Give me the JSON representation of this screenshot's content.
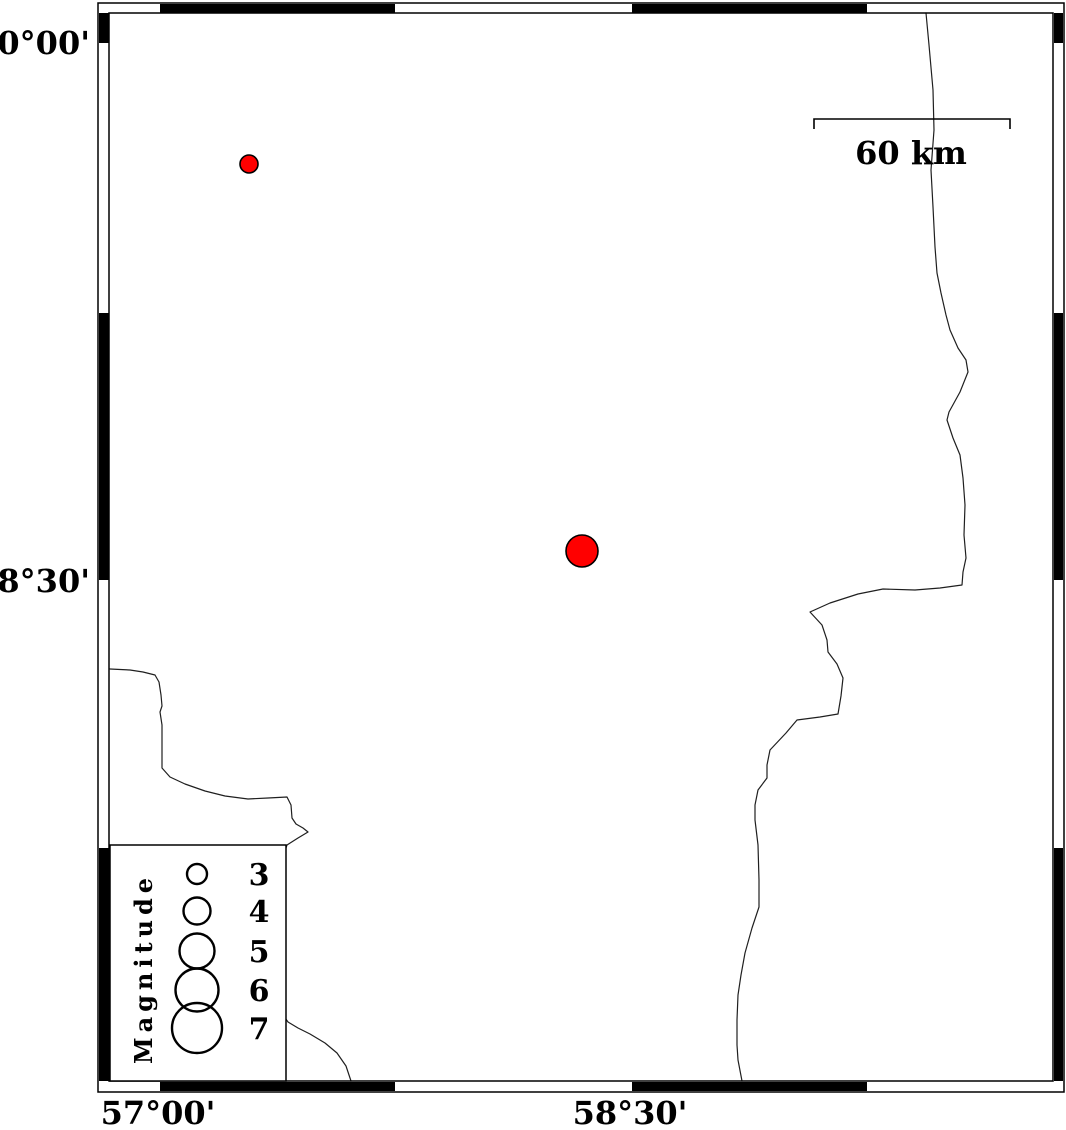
{
  "figure": {
    "kind": "earthquake-epicenter-map",
    "width": 1066,
    "height": 1130,
    "background": "#ffffff"
  },
  "colors": {
    "frame": "#000000",
    "coastline": "#1f1f1f",
    "epicenter_fill": "#ff0000",
    "epicenter_stroke": "#000000",
    "legend_box_fill": "#ffffff"
  },
  "frame": {
    "outer": {
      "x": 98,
      "y": 3,
      "w": 966,
      "h": 1089
    },
    "inner": {
      "x": 109,
      "y": 13,
      "w": 944,
      "h": 1068
    },
    "black_x_segments": [
      [
        160,
        395
      ],
      [
        632,
        867
      ]
    ],
    "black_y_segments": [
      [
        13,
        43
      ],
      [
        313,
        580
      ],
      [
        848,
        1081
      ]
    ]
  },
  "axis_labels": {
    "lat": [
      {
        "text": "30°00'",
        "x": 90,
        "y": 54
      },
      {
        "text": "28°30'",
        "x": 90,
        "y": 592
      }
    ],
    "lon": [
      {
        "text": "57°00'",
        "x": 158,
        "y": 1124
      },
      {
        "text": "58°30'",
        "x": 630,
        "y": 1124
      }
    ]
  },
  "scale_bar": {
    "label": "60 km",
    "x1": 814,
    "x2": 1010,
    "y": 119,
    "tick_drop": 10,
    "label_x": 911,
    "label_y": 164
  },
  "earthquakes": [
    {
      "cx": 249,
      "cy": 164,
      "r": 9,
      "magnitude_approx": 3
    },
    {
      "cx": 582,
      "cy": 551,
      "r": 16,
      "magnitude_approx": 5
    }
  ],
  "legend": {
    "title": "Magnitude",
    "box": {
      "x": 110,
      "y": 845,
      "w": 176,
      "h": 236
    },
    "title_translate_x": 152,
    "title_translate_y": 1064,
    "circle_cx": 197,
    "label_x": 259,
    "entries": [
      {
        "label": "3",
        "cy": 874,
        "r": 10,
        "label_y": 885
      },
      {
        "label": "4",
        "cy": 911,
        "r": 13.5,
        "label_y": 922
      },
      {
        "label": "5",
        "cy": 951,
        "r": 17.5,
        "label_y": 962
      },
      {
        "label": "6",
        "cy": 990,
        "r": 21.5,
        "label_y": 1001
      },
      {
        "label": "7",
        "cy": 1028,
        "r": 25,
        "label_y": 1039
      }
    ]
  },
  "coastlines": [
    {
      "name": "coastline-east",
      "points": [
        [
          926,
          13
        ],
        [
          929,
          45
        ],
        [
          933,
          90
        ],
        [
          934,
          130
        ],
        [
          931,
          170
        ],
        [
          933,
          207
        ],
        [
          935,
          247
        ],
        [
          937,
          273
        ],
        [
          941,
          293
        ],
        [
          946,
          315
        ],
        [
          950,
          330
        ],
        [
          958,
          348
        ],
        [
          966,
          360
        ],
        [
          968,
          372
        ],
        [
          960,
          392
        ],
        [
          949,
          412
        ],
        [
          947,
          420
        ],
        [
          953,
          438
        ],
        [
          960,
          455
        ],
        [
          963,
          478
        ],
        [
          965,
          505
        ],
        [
          964,
          535
        ],
        [
          966,
          558
        ],
        [
          963,
          572
        ],
        [
          962,
          585
        ],
        [
          940,
          588
        ],
        [
          915,
          590
        ],
        [
          883,
          589
        ],
        [
          858,
          594
        ],
        [
          830,
          603
        ],
        [
          810,
          612
        ],
        [
          822,
          625
        ],
        [
          827,
          640
        ],
        [
          828,
          652
        ],
        [
          837,
          664
        ],
        [
          843,
          678
        ],
        [
          841,
          696
        ],
        [
          838,
          714
        ],
        [
          820,
          717
        ],
        [
          797,
          720
        ],
        [
          786,
          733
        ],
        [
          770,
          750
        ],
        [
          767,
          765
        ],
        [
          767,
          778
        ],
        [
          758,
          790
        ],
        [
          755,
          805
        ],
        [
          755,
          820
        ],
        [
          758,
          845
        ],
        [
          759,
          880
        ],
        [
          759,
          907
        ],
        [
          752,
          928
        ],
        [
          745,
          953
        ],
        [
          741,
          975
        ],
        [
          738,
          995
        ],
        [
          737,
          1020
        ],
        [
          737,
          1045
        ],
        [
          738,
          1060
        ],
        [
          742,
          1081
        ]
      ]
    },
    {
      "name": "coastline-southwest",
      "points": [
        [
          110,
          669
        ],
        [
          130,
          670
        ],
        [
          143,
          672
        ],
        [
          155,
          675
        ],
        [
          159,
          682
        ],
        [
          161,
          695
        ],
        [
          162,
          706
        ],
        [
          160,
          712
        ],
        [
          162,
          725
        ],
        [
          162,
          745
        ],
        [
          162,
          768
        ],
        [
          170,
          777
        ],
        [
          185,
          784
        ],
        [
          205,
          791
        ],
        [
          225,
          796
        ],
        [
          248,
          799
        ],
        [
          268,
          798
        ],
        [
          287,
          797
        ],
        [
          291,
          805
        ],
        [
          292,
          818
        ],
        [
          296,
          824
        ],
        [
          303,
          828
        ],
        [
          308,
          832
        ],
        [
          298,
          838
        ],
        [
          287,
          845
        ],
        [
          278,
          870
        ],
        [
          272,
          910
        ],
        [
          270,
          950
        ],
        [
          274,
          990
        ],
        [
          281,
          1012
        ],
        [
          288,
          1022
        ],
        [
          298,
          1028
        ],
        [
          310,
          1034
        ],
        [
          325,
          1043
        ],
        [
          337,
          1053
        ],
        [
          346,
          1066
        ],
        [
          351,
          1081
        ]
      ]
    }
  ]
}
